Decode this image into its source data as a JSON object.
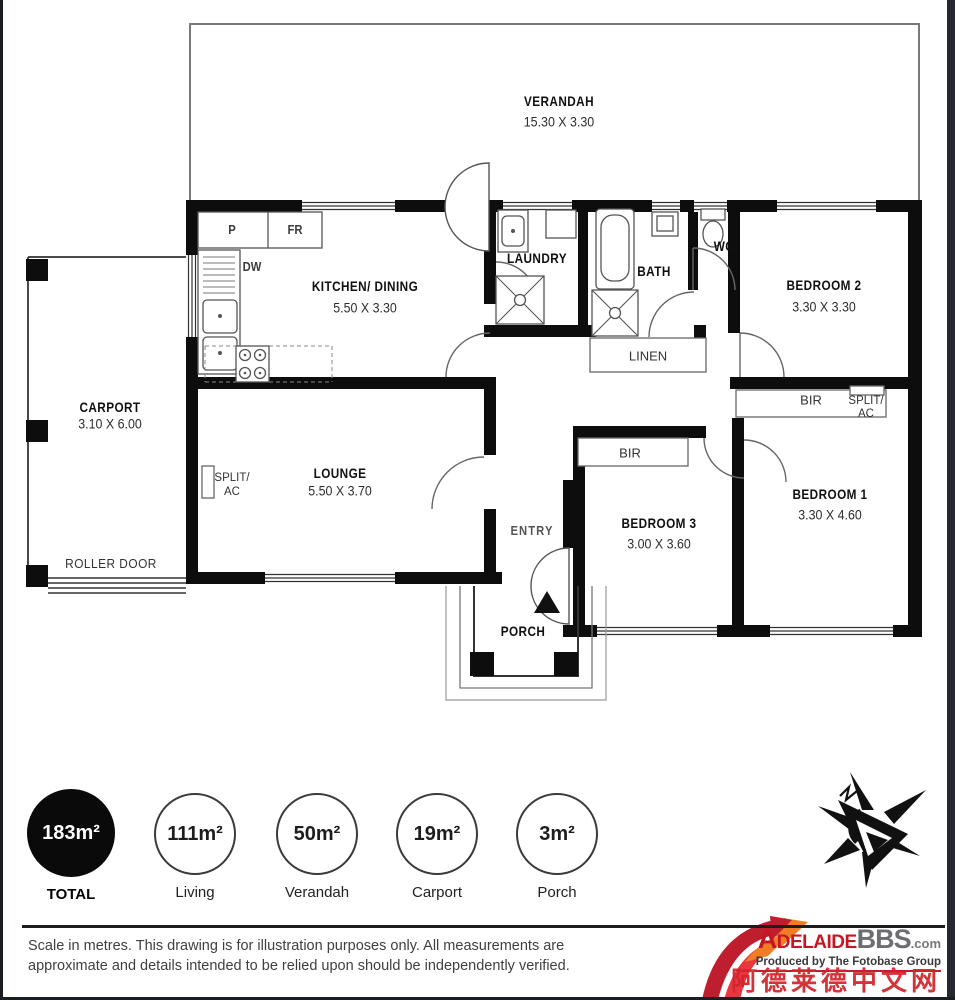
{
  "plan": {
    "rooms": {
      "verandah": {
        "name": "VERANDAH",
        "dims": "15.30 X 3.30"
      },
      "kitchen": {
        "name": "KITCHEN/ DINING",
        "dims": "5.50 X 3.30"
      },
      "laundry": {
        "name": "LAUNDRY"
      },
      "bath": {
        "name": "BATH"
      },
      "wc": {
        "name": "WC"
      },
      "bedroom2": {
        "name": "BEDROOM 2",
        "dims": "3.30 X 3.30"
      },
      "carport": {
        "name": "CARPORT",
        "dims": "3.10 X 6.00"
      },
      "lounge": {
        "name": "LOUNGE",
        "dims": "5.50 X 3.70"
      },
      "bedroom3": {
        "name": "BEDROOM 3",
        "dims": "3.00 X 3.60"
      },
      "bedroom1": {
        "name": "BEDROOM 1",
        "dims": "3.30 X 4.60"
      },
      "entry": {
        "name": "ENTRY"
      },
      "porch": {
        "name": "PORCH"
      }
    },
    "fixtures": {
      "pantry": "P",
      "fridge": "FR",
      "dishwasher": "DW",
      "linen": "LINEN",
      "built_in_robe": "BIR",
      "split_ac_top": "SPLIT/",
      "split_ac_bottom": "AC",
      "roller_door": "ROLLER DOOR"
    }
  },
  "legend": {
    "areas": [
      {
        "value": "183m²",
        "label": "TOTAL"
      },
      {
        "value": "111m²",
        "label": "Living"
      },
      {
        "value": "50m²",
        "label": "Verandah"
      },
      {
        "value": "19m²",
        "label": "Carport"
      },
      {
        "value": "3m²",
        "label": "Porch"
      }
    ]
  },
  "footer": {
    "line1": "Scale in metres. This drawing is for illustration purposes only. All measurements are",
    "line2": "approximate and details intended to be relied upon should be independently verified."
  },
  "watermark": {
    "brand": "Adelaide",
    "brand_bold": "BBS",
    "brand_suffix": ".com",
    "producer": "Produced by The Fotobase Group",
    "chinese": "阿德莱德中文网"
  },
  "colors": {
    "wall": "#0d0d0d",
    "brand_red": "#c41724",
    "brand_gray": "#6d6e71",
    "accent_orange": "#f07c26"
  }
}
